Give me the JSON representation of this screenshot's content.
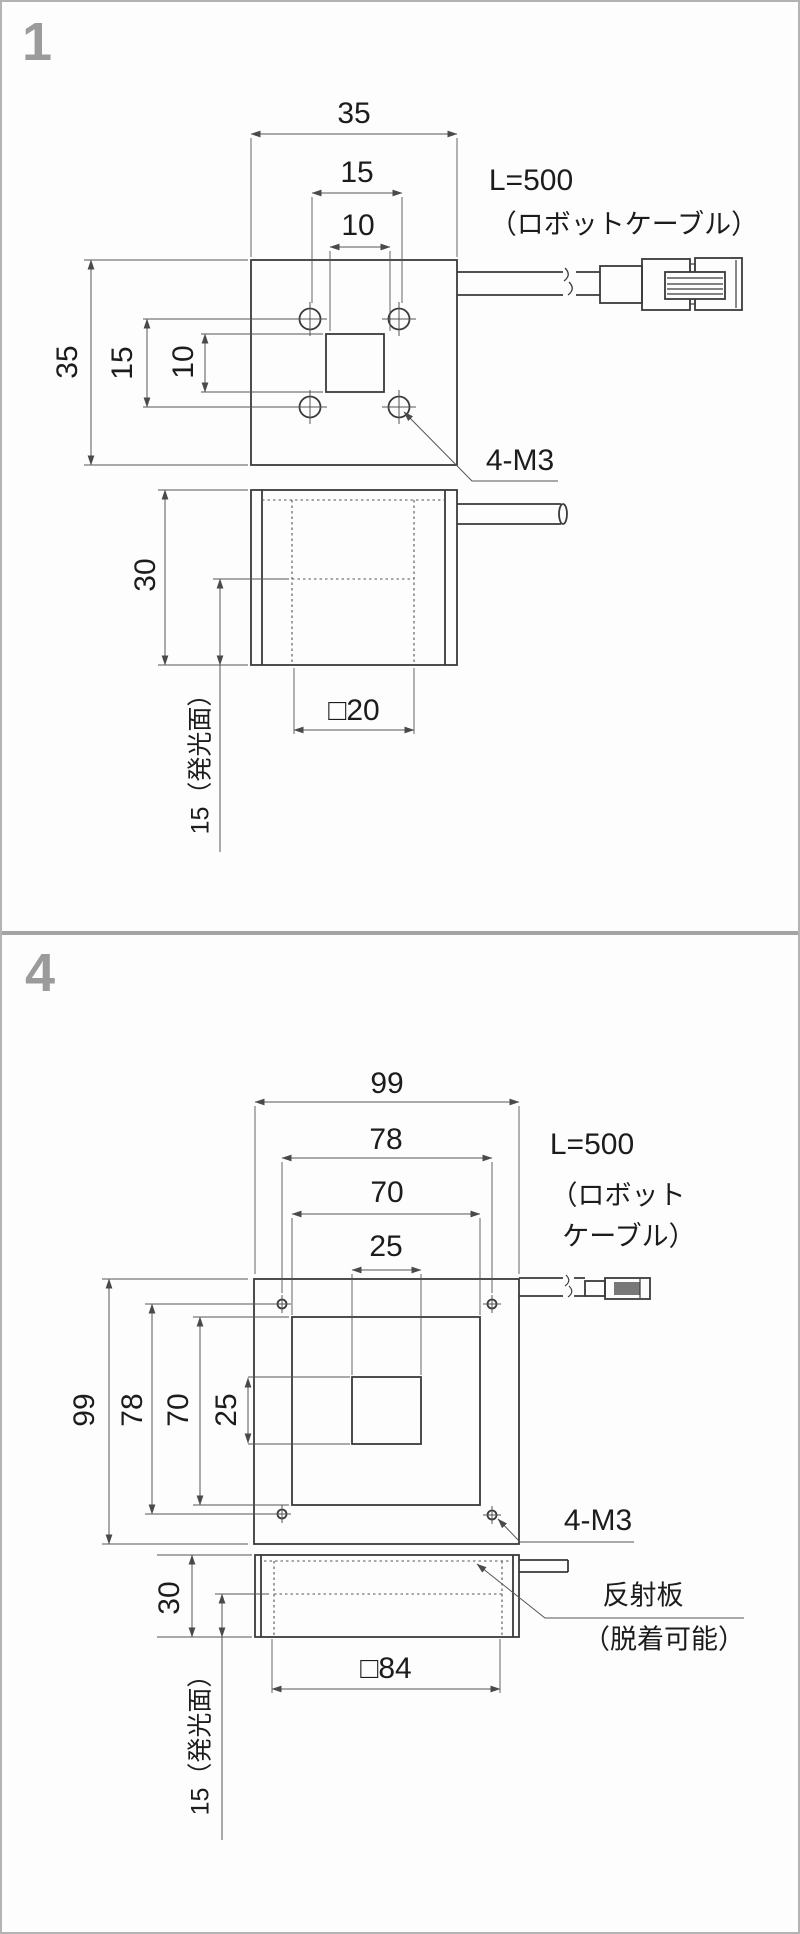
{
  "colors": {
    "object_line": "#3a3a3a",
    "dim_line": "#555555",
    "label_gray": "#9b9b9b",
    "connector_fill": "#787878",
    "frame_border": "#b3b3b3"
  },
  "panel_1": {
    "index_label": "1",
    "top_view": {
      "width": "35",
      "hole_spacing_h": "15",
      "window_w": "10",
      "height": "35",
      "hole_spacing_v": "15",
      "window_h": "10",
      "cable_line1": "L=500",
      "cable_line2": "（ロボットケーブル）",
      "screw_callout": "4-M3"
    },
    "side_view": {
      "height": "30",
      "emitting_size": "□20",
      "emitting_depth": "15（発光面）"
    }
  },
  "panel_4": {
    "index_label": "4",
    "top_view": {
      "width": "99",
      "hole_spacing_h": "78",
      "inner_w": "70",
      "window_w": "25",
      "height": "99",
      "hole_spacing_v": "78",
      "inner_h": "70",
      "window_h": "25",
      "cable_line1": "L=500",
      "cable_line2": "（ロボット",
      "cable_line3": "ケーブル）",
      "screw_callout": "4-M3"
    },
    "side_view": {
      "height": "30",
      "emitting_size": "□84",
      "emitting_depth": "15（発光面）",
      "reflector_line1": "反射板",
      "reflector_line2": "（脱着可能）"
    }
  }
}
